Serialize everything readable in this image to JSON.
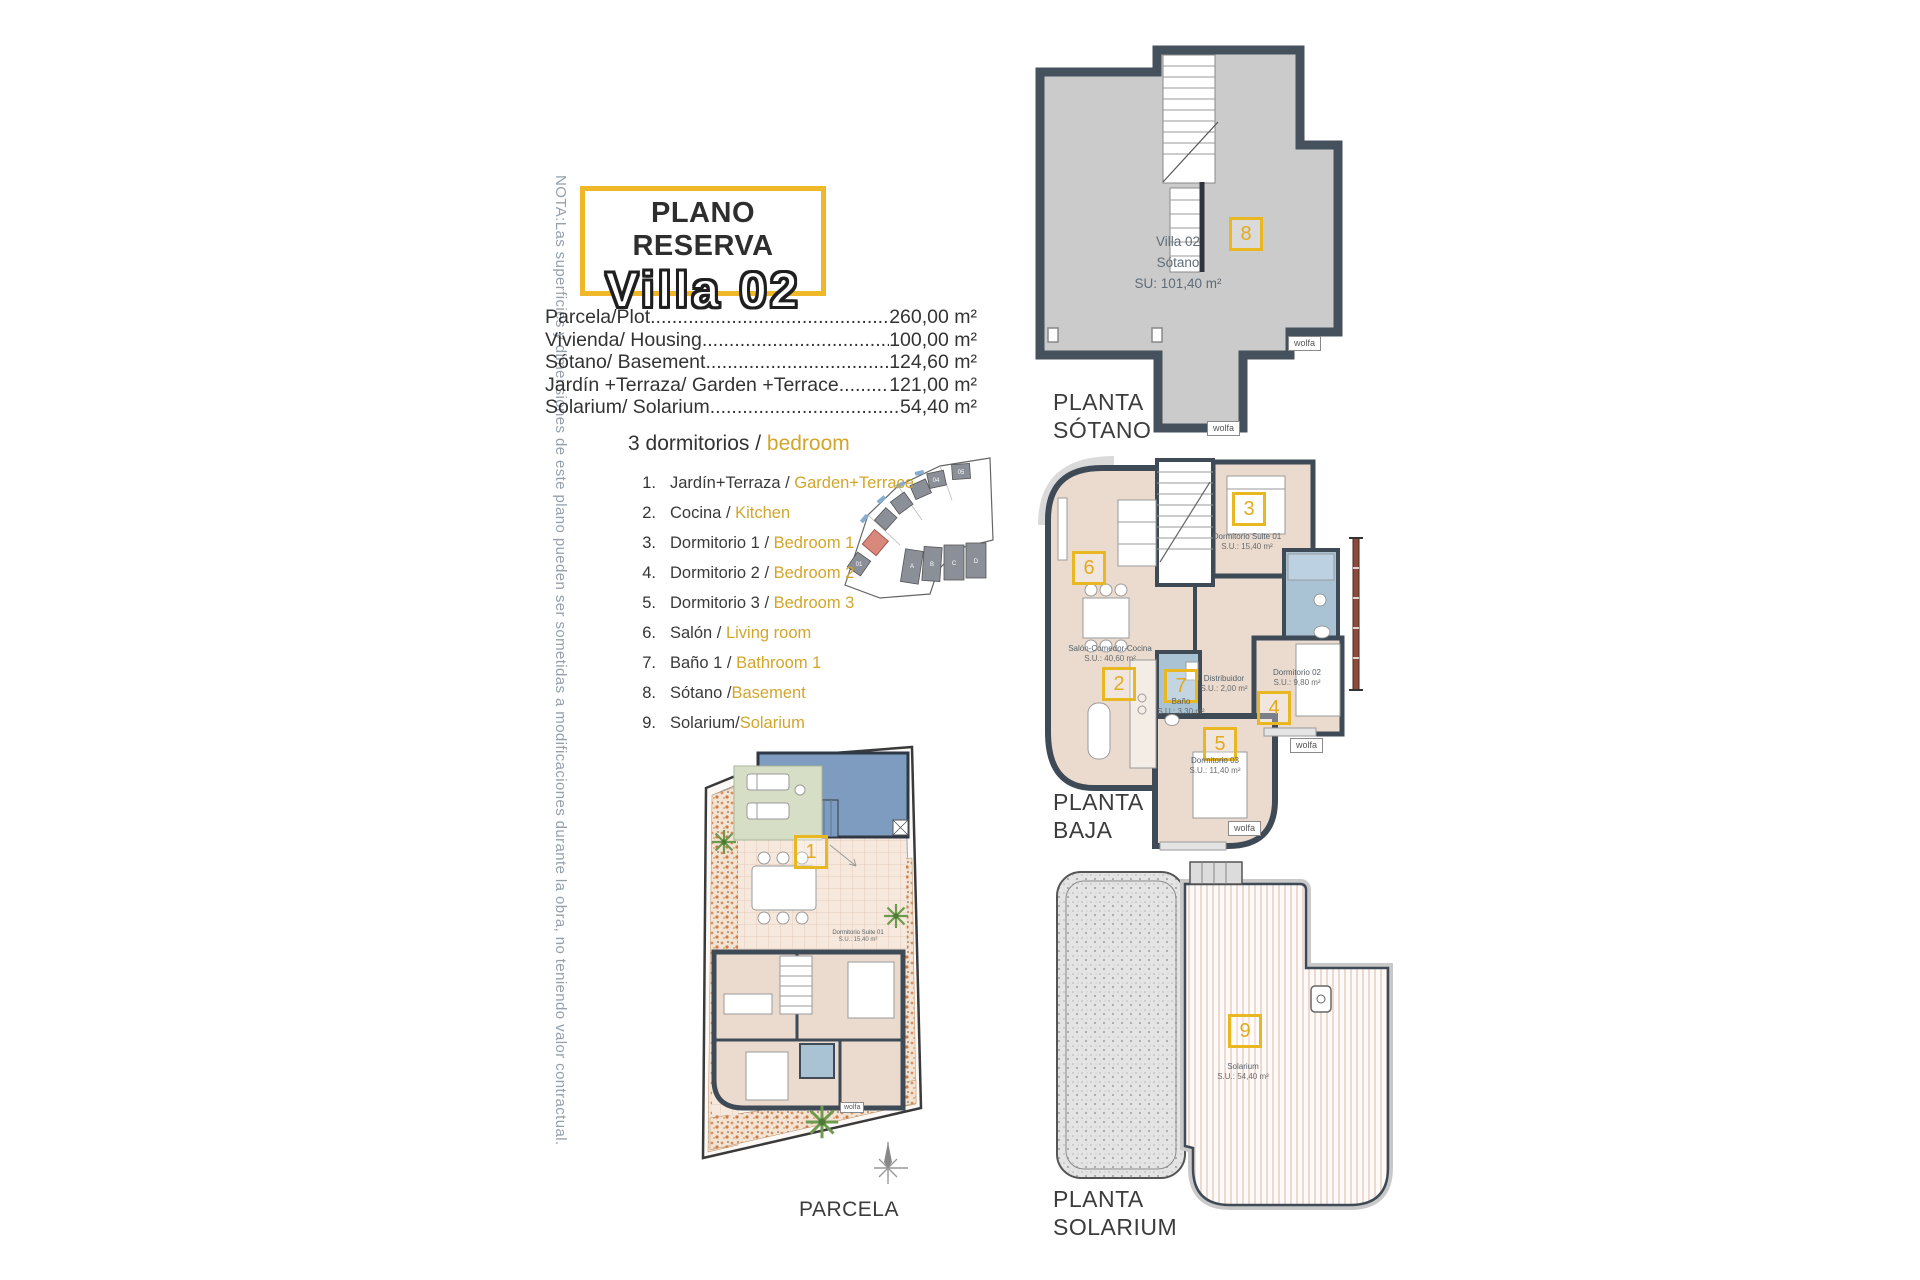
{
  "note": "NOTA:Las superficies y dimensiones de este plano pueden ser sometidas a modificaciones durante la obra, no teniendo valor contractual.",
  "title": {
    "kicker": "PLANO RESERVA",
    "name": "Villa 02"
  },
  "summary": [
    {
      "label": "Parcela/Plot",
      "value": "260,00 m²"
    },
    {
      "label": "Vivienda/ Housing",
      "value": "100,00 m²"
    },
    {
      "label": "Sótano/ Basement",
      "value": "124,60 m²"
    },
    {
      "label": "Jardín +Terraza/ Garden +Terrace",
      "value": "121,00 m²"
    },
    {
      "label": "Solarium/ Solarium",
      "value": "54,40 m²"
    }
  ],
  "legend": {
    "title_es": "3 dormitorios / ",
    "title_en": "bedroom",
    "items": [
      {
        "n": "1.",
        "es": "Jardín+Terraza / ",
        "en": "Garden+Terrace"
      },
      {
        "n": "2.",
        "es": "Cocina / ",
        "en": "Kitchen"
      },
      {
        "n": "3.",
        "es": "Dormitorio 1 / ",
        "en": "Bedroom 1"
      },
      {
        "n": "4.",
        "es": "Dormitorio 2 / ",
        "en": "Bedroom 2"
      },
      {
        "n": "5.",
        "es": "Dormitorio 3 / ",
        "en": "Bedroom 3"
      },
      {
        "n": "6.",
        "es": "Salón / ",
        "en": "Living room"
      },
      {
        "n": "7.",
        "es": "Baño 1 / ",
        "en": "Bathroom 1"
      },
      {
        "n": "8.",
        "es": "Sótano /",
        "en": "Basement"
      },
      {
        "n": "9.",
        "es": "Solarium/",
        "en": "Solarium"
      }
    ]
  },
  "brand": "wolfa",
  "sotano": {
    "caption1": "PLANTA",
    "caption2": "SÓTANO",
    "badge": "8",
    "l1": "Villa 02",
    "l2": "Sótano",
    "l3": "SU: 101,40 m²"
  },
  "baja": {
    "caption1": "PLANTA",
    "caption2": "BAJA",
    "salon": {
      "badge": "6",
      "name": "Salón-Comedor-Cocina",
      "area": "S.U.: 40,60 m²"
    },
    "suite": {
      "badge": "3",
      "name": "Dormitorio Suite 01",
      "area": "S.U.: 15,40 m²"
    },
    "cocina": {
      "badge": "2"
    },
    "bano": {
      "badge": "7",
      "name": "Baño",
      "area": "S.U.: 3,30 m²"
    },
    "distribuidor": {
      "name": "Distribuidor",
      "area": "S.U.: 2,00 m²"
    },
    "dorm2": {
      "badge": "4",
      "name": "Dormitorio 02",
      "area": "S.U.: 9,80 m²"
    },
    "dorm3": {
      "badge": "5",
      "name": "Dormitorio 03",
      "area": "S.U.: 11,40 m²"
    }
  },
  "parcela": {
    "caption": "PARCELA",
    "badge": "1",
    "suite_name": "Dormitorio Suite 01",
    "suite_area": "S.U.: 15,40 m²"
  },
  "solarium": {
    "caption1": "PLANTA",
    "caption2": "SOLARIUM",
    "badge": "9",
    "name": "Solarium",
    "area": "S.U.: 54,40 m²"
  },
  "minimap_labels": {
    "h01": "01",
    "h04": "04",
    "h05": "05",
    "a": "A",
    "b": "B",
    "c": "C",
    "d": "D"
  }
}
